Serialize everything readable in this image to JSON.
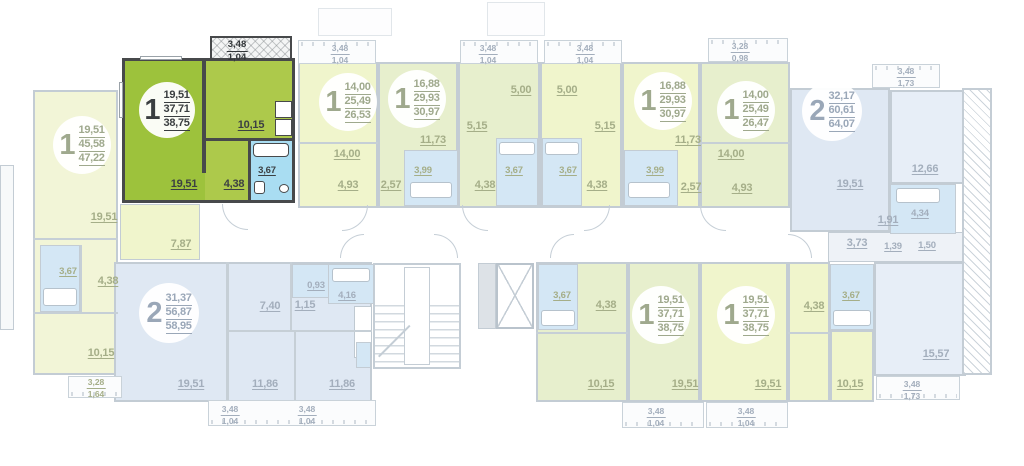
{
  "palette": {
    "highlight_fill": "#9dc23c",
    "highlight_fill_light": "#adc94b",
    "highlight_bath": "#a9ddf2",
    "highlight_wall": "#47494b",
    "faded_wall": "#c3ccd4",
    "pale_yellow": "#f2f5d7",
    "bright_yellow": "#f0f5cc",
    "pale_green": "#e7efcd",
    "pale_blue": "#dfe8f3",
    "pale_blue_light": "#e7eef7",
    "bath_blue": "#d4e7f5",
    "text_dark": "#3c4043",
    "text_faded": "#a3aebc",
    "text_olive": "#a5ae88"
  },
  "units": [
    {
      "id": "highlighted",
      "rooms": "1",
      "areas": [
        "19,51",
        "37,71",
        "38,75"
      ],
      "x": 167,
      "y": 110,
      "d": 56,
      "theme": "dark"
    },
    {
      "id": "left",
      "rooms": "1",
      "areas": [
        "19,51",
        "45,58",
        "47,22"
      ],
      "x": 82,
      "y": 145,
      "d": 58,
      "theme": "olive"
    },
    {
      "id": "a3",
      "rooms": "1",
      "areas": [
        "14,00",
        "25,49",
        "26,53"
      ],
      "x": 348,
      "y": 102,
      "d": 58,
      "theme": "olive"
    },
    {
      "id": "a4",
      "rooms": "1",
      "areas": [
        "16,88",
        "29,93",
        "30,97"
      ],
      "x": 417,
      "y": 99,
      "d": 58,
      "theme": "olive"
    },
    {
      "id": "a5",
      "rooms": "1",
      "areas": [
        "16,88",
        "29,93",
        "30,97"
      ],
      "x": 663,
      "y": 101,
      "d": 58,
      "theme": "olive"
    },
    {
      "id": "a6",
      "rooms": "1",
      "areas": [
        "14,00",
        "25,49",
        "26,47"
      ],
      "x": 746,
      "y": 110,
      "d": 58,
      "theme": "olive"
    },
    {
      "id": "a7",
      "rooms": "2",
      "areas": [
        "32,17",
        "60,61",
        "64,07"
      ],
      "x": 832,
      "y": 111,
      "d": 60,
      "theme": "blue"
    },
    {
      "id": "a8",
      "rooms": "2",
      "areas": [
        "31,37",
        "56,87",
        "58,95"
      ],
      "x": 169,
      "y": 313,
      "d": 60,
      "theme": "blue"
    },
    {
      "id": "a9",
      "rooms": "1",
      "areas": [
        "19,51",
        "37,71",
        "38,75"
      ],
      "x": 661,
      "y": 315,
      "d": 58,
      "theme": "olive"
    },
    {
      "id": "a10",
      "rooms": "1",
      "areas": [
        "19,51",
        "37,71",
        "38,75"
      ],
      "x": 746,
      "y": 315,
      "d": 58,
      "theme": "olive"
    }
  ],
  "room_labels": [
    {
      "text": "19,51",
      "x": 184,
      "y": 178,
      "theme": "dark"
    },
    {
      "text": "10,15",
      "x": 251,
      "y": 119,
      "theme": "dark"
    },
    {
      "text": "4,38",
      "x": 234,
      "y": 178,
      "theme": "dark"
    },
    {
      "text": "3,67",
      "x": 267,
      "y": 165,
      "theme": "dark",
      "small": true
    },
    {
      "text": "19,51",
      "x": 104,
      "y": 211,
      "theme": "olive"
    },
    {
      "text": "3,67",
      "x": 68,
      "y": 266,
      "theme": "olive",
      "small": true
    },
    {
      "text": "4,38",
      "x": 108,
      "y": 275,
      "theme": "olive"
    },
    {
      "text": "10,15",
      "x": 101,
      "y": 347,
      "theme": "olive"
    },
    {
      "text": "14,00",
      "x": 347,
      "y": 148,
      "theme": "olive"
    },
    {
      "text": "4,93",
      "x": 348,
      "y": 179,
      "theme": "olive"
    },
    {
      "text": "2,57",
      "x": 391,
      "y": 179,
      "theme": "olive"
    },
    {
      "text": "3,99",
      "x": 423,
      "y": 165,
      "theme": "olive",
      "small": true
    },
    {
      "text": "11,73",
      "x": 433,
      "y": 134,
      "theme": "olive"
    },
    {
      "text": "5,15",
      "x": 477,
      "y": 120,
      "theme": "olive"
    },
    {
      "text": "5,00",
      "x": 521,
      "y": 84,
      "theme": "olive"
    },
    {
      "text": "3,67",
      "x": 514,
      "y": 165,
      "theme": "olive",
      "small": true
    },
    {
      "text": "4,38",
      "x": 485,
      "y": 179,
      "theme": "olive"
    },
    {
      "text": "5,00",
      "x": 567,
      "y": 84,
      "theme": "olive"
    },
    {
      "text": "5,15",
      "x": 605,
      "y": 120,
      "theme": "olive"
    },
    {
      "text": "3,67",
      "x": 568,
      "y": 165,
      "theme": "olive",
      "small": true
    },
    {
      "text": "4,38",
      "x": 597,
      "y": 179,
      "theme": "olive"
    },
    {
      "text": "11,73",
      "x": 688,
      "y": 134,
      "theme": "olive"
    },
    {
      "text": "3,99",
      "x": 655,
      "y": 165,
      "theme": "olive",
      "small": true
    },
    {
      "text": "2,57",
      "x": 691,
      "y": 181,
      "theme": "olive"
    },
    {
      "text": "14,00",
      "x": 731,
      "y": 148,
      "theme": "olive"
    },
    {
      "text": "4,93",
      "x": 742,
      "y": 182,
      "theme": "olive"
    },
    {
      "text": "19,51",
      "x": 850,
      "y": 178,
      "theme": "blue"
    },
    {
      "text": "12,66",
      "x": 925,
      "y": 163,
      "theme": "blue"
    },
    {
      "text": "1,91",
      "x": 888,
      "y": 214,
      "theme": "blue"
    },
    {
      "text": "4,34",
      "x": 920,
      "y": 208,
      "theme": "blue",
      "small": true
    },
    {
      "text": "3,73",
      "x": 857,
      "y": 237,
      "theme": "blue"
    },
    {
      "text": "1,39",
      "x": 893,
      "y": 241,
      "theme": "blue",
      "small": true
    },
    {
      "text": "1,50",
      "x": 927,
      "y": 240,
      "theme": "blue",
      "small": true
    },
    {
      "text": "15,57",
      "x": 936,
      "y": 348,
      "theme": "blue"
    },
    {
      "text": "7,87",
      "x": 181,
      "y": 238,
      "theme": "olive"
    },
    {
      "text": "7,40",
      "x": 270,
      "y": 300,
      "theme": "blue"
    },
    {
      "text": "0,93",
      "x": 316,
      "y": 280,
      "theme": "blue",
      "small": true
    },
    {
      "text": "1,15",
      "x": 305,
      "y": 299,
      "theme": "blue"
    },
    {
      "text": "4,16",
      "x": 347,
      "y": 290,
      "theme": "blue",
      "small": true
    },
    {
      "text": "19,51",
      "x": 191,
      "y": 378,
      "theme": "blue"
    },
    {
      "text": "11,86",
      "x": 265,
      "y": 378,
      "theme": "blue"
    },
    {
      "text": "11,86",
      "x": 342,
      "y": 378,
      "theme": "blue"
    },
    {
      "text": "3,67",
      "x": 562,
      "y": 290,
      "theme": "olive",
      "small": true
    },
    {
      "text": "4,38",
      "x": 606,
      "y": 299,
      "theme": "olive"
    },
    {
      "text": "10,15",
      "x": 601,
      "y": 378,
      "theme": "olive"
    },
    {
      "text": "19,51",
      "x": 685,
      "y": 378,
      "theme": "olive"
    },
    {
      "text": "19,51",
      "x": 768,
      "y": 378,
      "theme": "olive"
    },
    {
      "text": "4,38",
      "x": 814,
      "y": 300,
      "theme": "olive"
    },
    {
      "text": "3,67",
      "x": 851,
      "y": 290,
      "theme": "olive",
      "small": true
    },
    {
      "text": "10,15",
      "x": 850,
      "y": 378,
      "theme": "olive"
    }
  ],
  "balcony_labels": [
    {
      "top": "3,48",
      "bottom": "1,04",
      "x": 237,
      "y": 39,
      "theme": "dark"
    },
    {
      "top": "3,48",
      "bottom": "1,04",
      "x": 340,
      "y": 43,
      "theme": "blue"
    },
    {
      "top": "3,48",
      "bottom": "1,04",
      "x": 488,
      "y": 43,
      "theme": "blue"
    },
    {
      "top": "3,48",
      "bottom": "1,04",
      "x": 585,
      "y": 43,
      "theme": "blue"
    },
    {
      "top": "3,28",
      "bottom": "0,98",
      "x": 740,
      "y": 41,
      "theme": "blue"
    },
    {
      "top": "3,48",
      "bottom": "1,73",
      "x": 906,
      "y": 66,
      "theme": "blue"
    },
    {
      "top": "3,28",
      "bottom": "1,64",
      "x": 96,
      "y": 377,
      "theme": "olive"
    },
    {
      "top": "3,48",
      "bottom": "1,04",
      "x": 230,
      "y": 404,
      "theme": "blue"
    },
    {
      "top": "3,48",
      "bottom": "1,04",
      "x": 307,
      "y": 404,
      "theme": "blue"
    },
    {
      "top": "3,48",
      "bottom": "1,04",
      "x": 656,
      "y": 406,
      "theme": "blue"
    },
    {
      "top": "3,48",
      "bottom": "1,04",
      "x": 746,
      "y": 406,
      "theme": "blue"
    },
    {
      "top": "3,48",
      "bottom": "1,73",
      "x": 912,
      "y": 379,
      "theme": "blue"
    }
  ]
}
